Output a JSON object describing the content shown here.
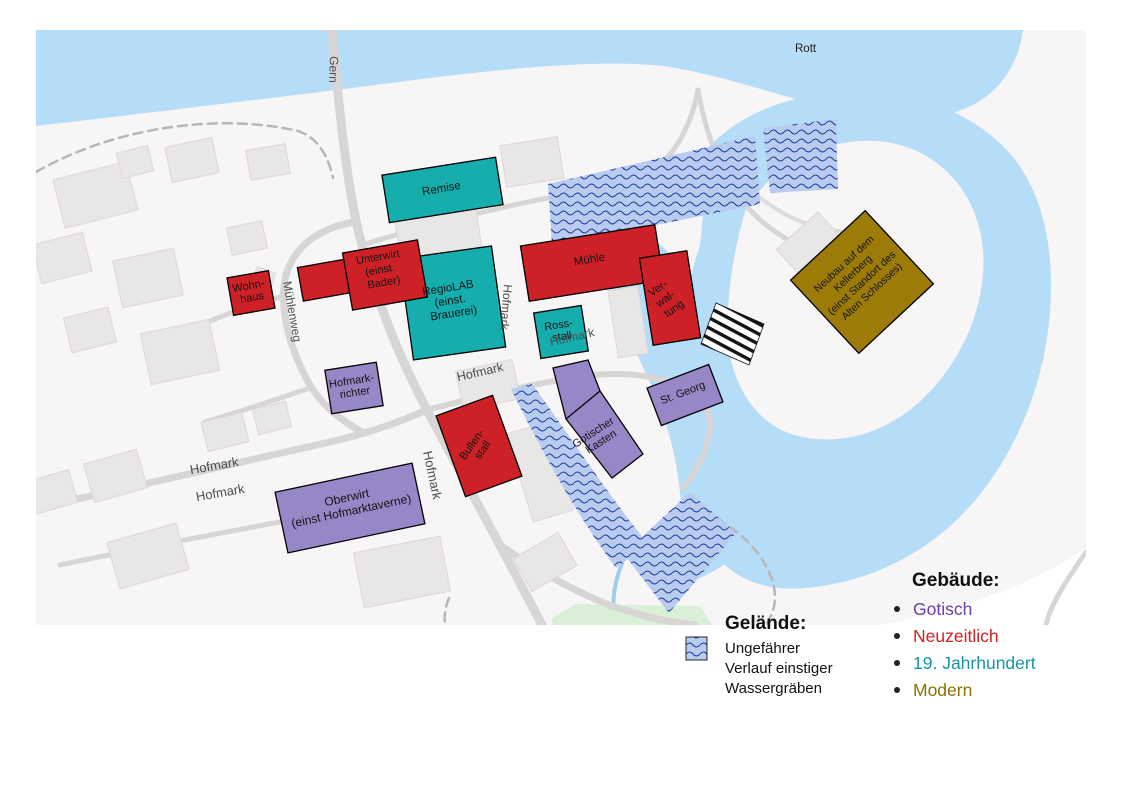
{
  "era_colors": {
    "gotisch": "#9787c7",
    "neuzeitlich": "#ce2127",
    "jahrhundert19": "#16adad",
    "modern": "#9c7b08"
  },
  "map": {
    "background": "#f7f5f5",
    "water_color": "#b5ddf8",
    "ditch_fill": "#b9ccef",
    "ditch_wave_color": "#1d3e9e",
    "river_label": "Rott",
    "streets": {
      "gern": "Gern",
      "muehlenweg": "Mühlenweg",
      "hofmark_a": "Hofmark",
      "hofmark_b": "Hofmark",
      "hofmark_c": "Hofmark",
      "hofmark_d": "Hofmark",
      "hofmark_e": "Hofmark",
      "hofmark_f": "Hofmark"
    },
    "buildings": {
      "remise": {
        "era": "19. Jahrhundert",
        "lines": [
          "Remise"
        ]
      },
      "regiolab": {
        "era": "19. Jahrhundert",
        "lines": [
          "RegioLAB",
          "(einst.",
          "Brauerei)"
        ]
      },
      "rossstall": {
        "era": "19. Jahrhundert",
        "lines": [
          "Ross-",
          "stall"
        ]
      },
      "wohnhaus": {
        "era": "Neuzeitlich",
        "lines": [
          "Wohn-",
          "haus"
        ]
      },
      "unterwirt": {
        "era": "Neuzeitlich",
        "lines": [
          "Unterwirt",
          "(einst.",
          "Bader)"
        ]
      },
      "muehle": {
        "era": "Neuzeitlich",
        "lines": [
          "Mühle"
        ]
      },
      "verwaltung": {
        "era": "Neuzeitlich",
        "lines": [
          "Ver-",
          "wal-",
          "tung"
        ]
      },
      "bullenstall": {
        "era": "Neuzeitlich",
        "lines": [
          "Bullen-",
          "stall"
        ]
      },
      "hofmarkrichter": {
        "era": "Gotisch",
        "lines": [
          "Hofmark-",
          "richter"
        ]
      },
      "oberwirt": {
        "era": "Gotisch",
        "lines": [
          "Oberwirt",
          "(einst Hofmarktaverne)"
        ]
      },
      "gotischer_kasten": {
        "era": "Gotisch",
        "lines": [
          "Gotischer",
          "Kasten"
        ]
      },
      "st_georg": {
        "era": "Gotisch",
        "lines": [
          "St. Georg"
        ]
      },
      "neubau": {
        "era": "Modern",
        "lines": [
          "Neubau auf dem",
          "Kellerberg",
          "(einst Standort des",
          "Alten Schlosses)"
        ]
      }
    }
  },
  "legend_terrain": {
    "title": "Gelände:",
    "lines": [
      "Ungefährer",
      "Verlauf einstiger",
      "Wassergräben"
    ]
  },
  "legend_buildings": {
    "title": "Gebäude:",
    "items": [
      {
        "label": "Gotisch",
        "color": "#6b3fa3"
      },
      {
        "label": "Neuzeitlich",
        "color": "#d32121"
      },
      {
        "label": "19. Jahrhundert",
        "color": "#1795a5"
      },
      {
        "label": "Modern",
        "color": "#8a7104"
      }
    ]
  }
}
